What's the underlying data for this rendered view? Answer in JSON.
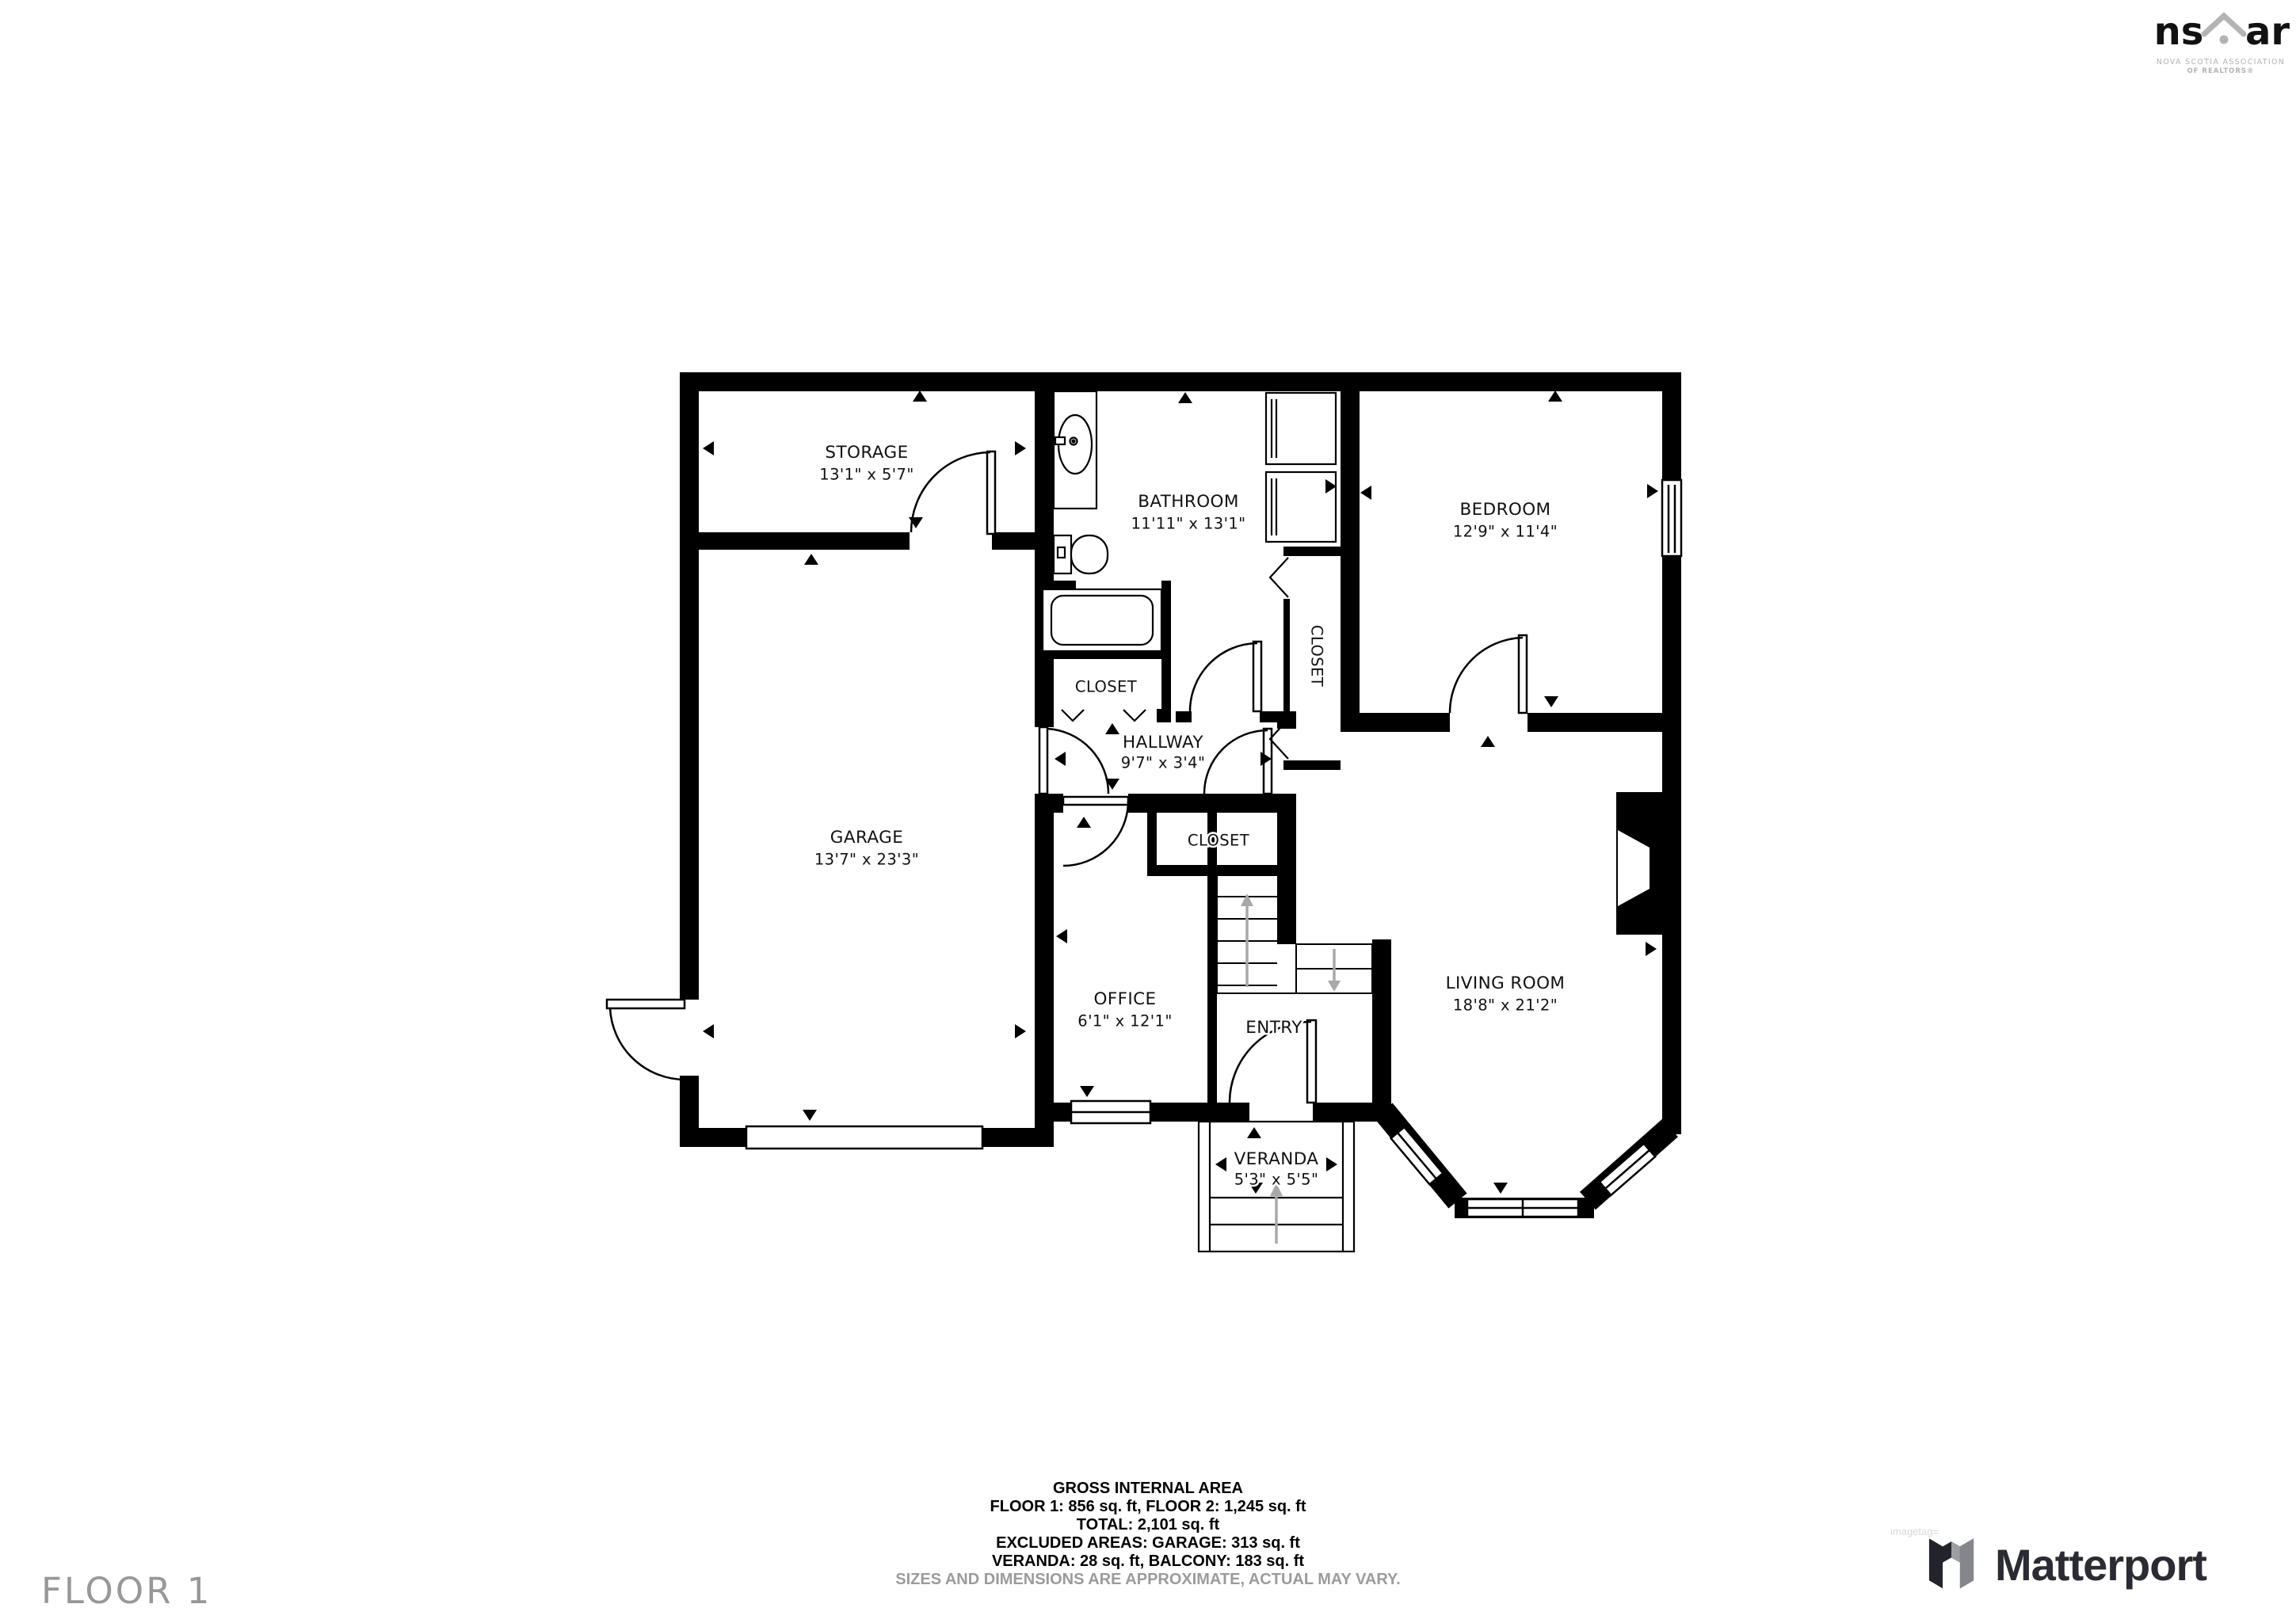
{
  "floor_label": "FLOOR 1",
  "rooms": {
    "storage": {
      "name": "STORAGE",
      "dims": "13'1\" x 5'7\""
    },
    "bathroom": {
      "name": "BATHROOM",
      "dims": "11'11\" x 13'1\""
    },
    "bedroom": {
      "name": "BEDROOM",
      "dims": "12'9\" x 11'4\""
    },
    "garage": {
      "name": "GARAGE",
      "dims": "13'7\" x 23'3\""
    },
    "hallway": {
      "name": "HALLWAY",
      "dims": "9'7\" x 3'4\""
    },
    "office": {
      "name": "OFFICE",
      "dims": "6'1\" x 12'1\""
    },
    "living_room": {
      "name": "LIVING ROOM",
      "dims": "18'8\" x 21'2\""
    },
    "entry": {
      "name": "ENTRY"
    },
    "veranda": {
      "name": "VERANDA",
      "dims": "5'3\" x 5'5\""
    },
    "closet_bath": {
      "name": "CLOSET"
    },
    "closet_mid": {
      "name": "CLOSET"
    },
    "closet_hall": {
      "name": "CLOSET"
    }
  },
  "footer": {
    "line1": "GROSS INTERNAL AREA",
    "line2": "FLOOR 1: 856 sq. ft, FLOOR 2: 1,245 sq. ft",
    "line3": "TOTAL: 2,101 sq. ft",
    "line4": "EXCLUDED AREAS: GARAGE: 313 sq. ft",
    "line5": "VERANDA: 28 sq. ft, BALCONY: 183 sq. ft",
    "disclaimer": "SIZES AND DIMENSIONS ARE APPROXIMATE, ACTUAL MAY VARY."
  },
  "branding": {
    "nsar": {
      "abbr_left": "ns",
      "abbr_right": "ar",
      "line1": "NOVA SCOTIA ASSOCIATION",
      "line2": "OF REALTORS®"
    },
    "matterport": {
      "name": "Matterport"
    },
    "watermark": "imagetag="
  },
  "colors": {
    "wall": "#000000",
    "label_text": "#111111",
    "muted_gray": "#9b9b9b",
    "logo_gray": "#b3b3b7",
    "matterport_dark": "#2b2b33",
    "arrow_gray": "#a8a8a8"
  }
}
